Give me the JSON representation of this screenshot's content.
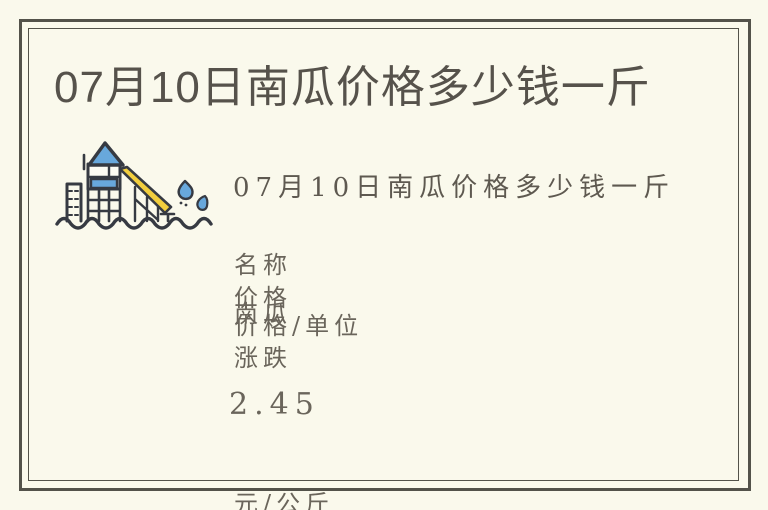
{
  "card": {
    "title": "07月10日南瓜价格多少钱一斤",
    "hero": {
      "icon": "water-slide-playground-icon",
      "caption": "07月10日南瓜价格多少钱一斤"
    },
    "content_lines": [
      "名称",
      "价格",
      "南瓜",
      "价格/单位",
      "涨跌",
      "2.45",
      "元/公斤"
    ],
    "price_info": {
      "labels": [
        "名称",
        "价格/单位",
        "涨跌"
      ],
      "name": "南瓜",
      "price": "2.45",
      "unit": "元/公斤"
    },
    "colors": {
      "background": "#faf9ec",
      "frame_border": "#53524a",
      "title_text": "#56524b",
      "body_text": "#6a655b",
      "illustration_blue": "#68a8dc",
      "illustration_yellow": "#f2ce3e",
      "illustration_outline": "#363a42"
    }
  }
}
